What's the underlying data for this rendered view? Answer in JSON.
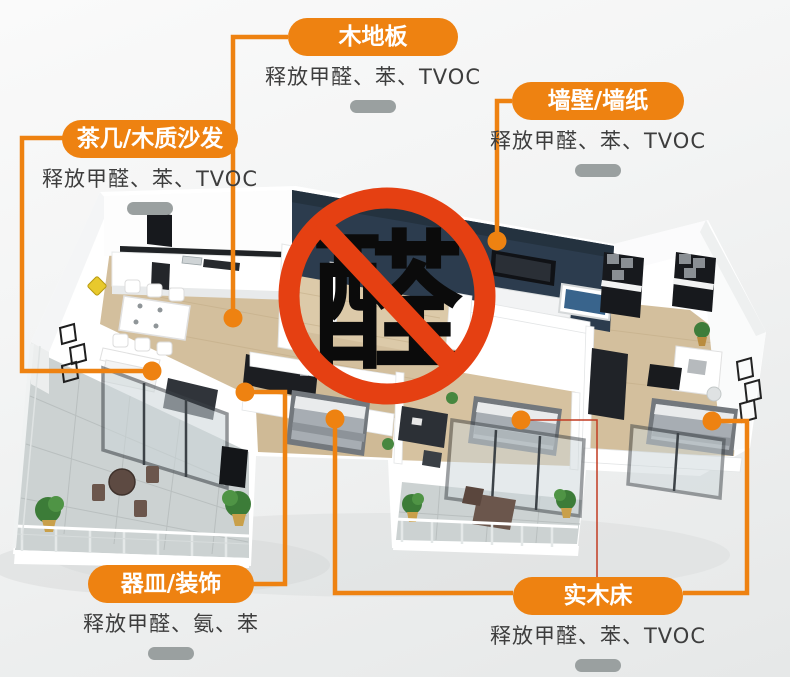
{
  "prohibition": {
    "character": "醛",
    "circle_color": "#e54012"
  },
  "labels": {
    "floor": {
      "title": "木地板",
      "subtitle": "释放甲醛、苯、TVOC"
    },
    "wall": {
      "title": "墙壁/墙纸",
      "subtitle": "释放甲醛、苯、TVOC"
    },
    "sofa": {
      "title": "茶几/木质沙发",
      "subtitle": "释放甲醛、苯、TVOC"
    },
    "decor": {
      "title": "器皿/装饰",
      "subtitle": "释放甲醛、氨、苯"
    },
    "bed": {
      "title": "实木床",
      "subtitle": "释放甲醛、苯、TVOC"
    }
  },
  "colors": {
    "accent_orange": "#ee8211",
    "prohibition_red": "#e54012",
    "thin_connector_red": "#c23b22",
    "navy_wall": "#2c3c4e",
    "wood_floor": "#d3bf9d",
    "tile_floor": "#ccd2d2",
    "gray_dash": "#9aa0a0",
    "subtitle_text": "#3d3d3d"
  }
}
